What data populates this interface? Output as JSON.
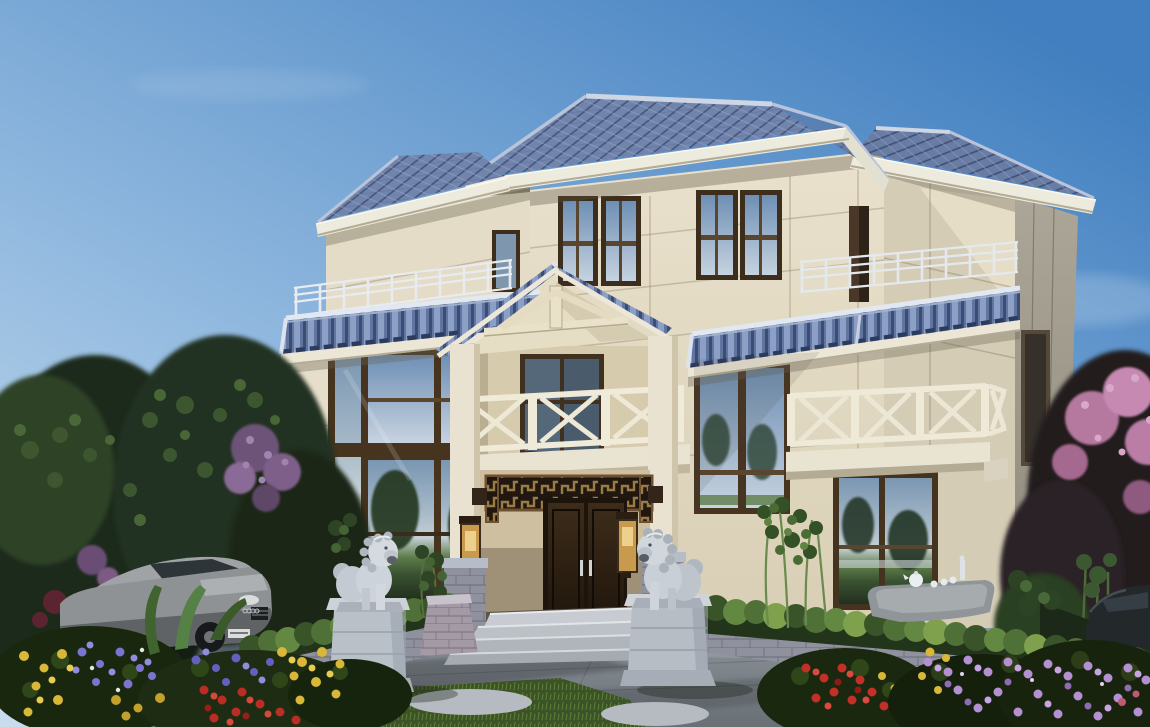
{
  "scene": {
    "description": "Daytime architectural rendering of a three-storey new-Chinese-style villa with blue tiled hip roofs, cream travertine facade, a central gabled entrance portico with balcony, white X-pattern balustrades, two stone guardian lions flanking the entrance steps, landscaped garden with hedges and flower beds, and two parked cars",
    "setting": "daytime, clear sky",
    "sky": {
      "top_right": "#417fc0",
      "bottom_left": "#cadded",
      "clouds": "faint wisps"
    },
    "building": {
      "storeys": 3,
      "style": "new Chinese villa",
      "roof": {
        "type": "multi-level hipped with gabled entrance porch",
        "tile_color": "#7084ac",
        "tile_shadow": "#46557c",
        "fascia_color": "#ecebdd"
      },
      "facade": {
        "stone_light": "#e7dfca",
        "stone_mid": "#d5ccb6",
        "shaded_face": "#a9a294",
        "joint_lines": "#77684c"
      },
      "windows": {
        "frame_color": "#46341f",
        "sky_reflection": "#9db2c4",
        "tree_reflection": "#2f4638",
        "lawn_reflection": "#5d7c49",
        "third_floor_window_pairs": 2
      },
      "terraces": {
        "metal_railing_color": "#e8ecf0",
        "left_terrace": true,
        "right_terrace": true
      },
      "portico": {
        "gable_roof": true,
        "columns": 2,
        "balustrade_style": "white X-pattern",
        "carved_lattice_lintel": "#9a7a45",
        "double_door_color": "#3d2c1a",
        "door_handles": "silver",
        "wall_lanterns": 2,
        "lantern_color": "#c79a4e"
      },
      "right_balcony": {
        "balustrade_style": "white X-pattern"
      }
    },
    "landscape": {
      "stone_lions": 2,
      "lion_stone_color": "#d2d7dc",
      "lion_pedestal_color": "#b9c0c8",
      "entrance_steps": 4,
      "step_stone_color": "#c8ccd2",
      "ramp_brick_color": "#a39aa6",
      "planter_wall_brick": "#8f91a1",
      "hedge_color": "#4f7036",
      "grass_color": "#3c5227",
      "pavement_color": "#8a9096",
      "stepping_stones": "light grey ovals",
      "tea_table": "stone slab with white teapot and cups",
      "bamboo_clumps": 3,
      "flowers": {
        "purple_blue": "#7b74cf",
        "yellow": "#d9b838",
        "red": "#c23028",
        "pink_purple": "#b48fd2"
      },
      "trees_left": "large dark green canopies with purple blossom accents",
      "trees_right": "pink blossom tree over dark plum foliage with bamboo"
    },
    "vehicles": {
      "left_car": {
        "color": "silver grey",
        "body_hex": "#8e9294",
        "license_plate": "white, illegible"
      },
      "right_car": {
        "color": "dark grey",
        "body_hex": "#23282b"
      }
    }
  }
}
